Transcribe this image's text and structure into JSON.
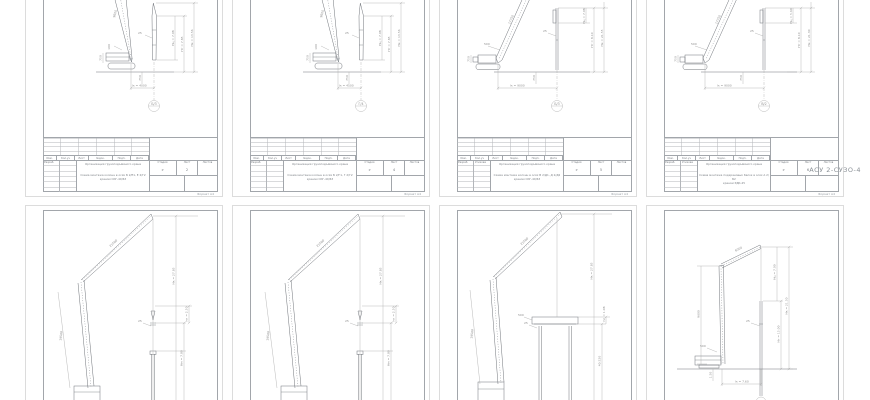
{
  "app": {
    "background": "#ffffff",
    "page_border": "#dcdcdc",
    "frame_color": "#a2a6ab",
    "ink": "#70747a",
    "dim_ink": "#a8a8a8",
    "format_label": "Формат  А4"
  },
  "title_block": {
    "rev_headers": [
      "Изм.",
      "Кол.уч",
      "Лист",
      "№док.",
      "Подп.",
      "Дата"
    ],
    "role_label": "Разраб.",
    "stage_label": "Стадия",
    "sheet_label": "Лист",
    "sheets_label": "Листов",
    "stage_value": "Р"
  },
  "sheets": [
    {
      "label": "Лист 1",
      "callout": "Б/3",
      "author": "",
      "org": "Организация грузоподъёмного крана",
      "title_line1": "Схема монтажа колонн в осях Б 2/Е1, Е 2/Г2",
      "title_line2": "краном СКГ-40/63",
      "sheet_no": "2",
      "dims": {
        "mast": "9600",
        "leader": "100",
        "cab": "750",
        "span": "lк = 4000",
        "h1": "Нк = 13.56",
        "h2": "Нт = 7.85",
        "h3": "Нц = 7.08",
        "small": "25",
        "pier": "750"
      }
    },
    {
      "label": "Лист 2",
      "callout": "Г/4",
      "author": "",
      "org": "Организация грузоподъёмного крана",
      "title_line1": "Схема монтажа колонн в осях Б 2/Г1, Г 2/Г2",
      "title_line2": "краном СКГ-40/63",
      "sheet_no": "4",
      "dims": {
        "mast": "9600",
        "leader": "100",
        "cab": "750",
        "span": "lк = 4500",
        "h1": "Нк = 13.56",
        "h2": "Нт = 7.85",
        "h3": "Нц = 7.08",
        "small": "25",
        "pier": "750"
      }
    },
    {
      "label": "Лист 3",
      "callout": "Б/3",
      "author": "Усикова",
      "org": "Организация грузоподъёмного крана",
      "title_line1": "Схема монтажа колонн в осях В 2/Д1, Д 2/Д2",
      "title_line2": "краном СКГ-40/63",
      "sheet_no": "5",
      "dims": {
        "boom": "17750",
        "leader": "500",
        "cab": "750",
        "span": "lк = 9000",
        "h1": "Нк = 21.55",
        "h2": "Нт = 8.10",
        "h3": "Нц = 7.08",
        "small": "25",
        "pier": "750"
      }
    },
    {
      "label": "Лист 4",
      "callout": "В/2",
      "author": "Усикова",
      "org": "Организация грузоподъёмного крана",
      "title_line1": "Схема монтажа подкрановых балок в осях А 2/Б2",
      "title_line2": "краном РДК-25",
      "sheet_no": "6",
      "overlay": "АСУ 2-СУЗО-4",
      "dims": {
        "boom": "17750",
        "leader": "500",
        "cab": "750",
        "span": "lк = 9000",
        "h1": "Нк = 21.30",
        "h2": "Нт = 8.10",
        "h3": "Нц = 5.60",
        "small": "25",
        "pier": "750"
      }
    },
    {
      "label": "Лист 5",
      "dims": {
        "jib": "21500",
        "tower": "19500",
        "h1": "Нк = 27.85",
        "h2": "Нм = 7.80",
        "h3": "hп = 2.50",
        "small": "25"
      }
    },
    {
      "label": "Лист 6",
      "dims": {
        "jib": "21500",
        "tower": "19500",
        "h1": "Нк = 27.85",
        "h2": "Нм = 7.80",
        "h3": "hп = 2.50",
        "small": "25"
      }
    },
    {
      "label": "Лист 7",
      "dims": {
        "jib": "21500",
        "tower": "19500",
        "h1": "Нк = 27.85",
        "col": "40.520",
        "h3": "hп = 1.08",
        "small": "25",
        "base": "500"
      }
    },
    {
      "label": "Лист 8",
      "callout": "В/2",
      "dims": {
        "mast": "9600",
        "jib": "6000",
        "h1": "Нк = 21.50",
        "h2": "Нт = 15.00",
        "h3": "Нц = 7.00",
        "span": "lк = 7.60",
        "leader": "500",
        "small": "25",
        "ground": "1.50"
      }
    }
  ]
}
